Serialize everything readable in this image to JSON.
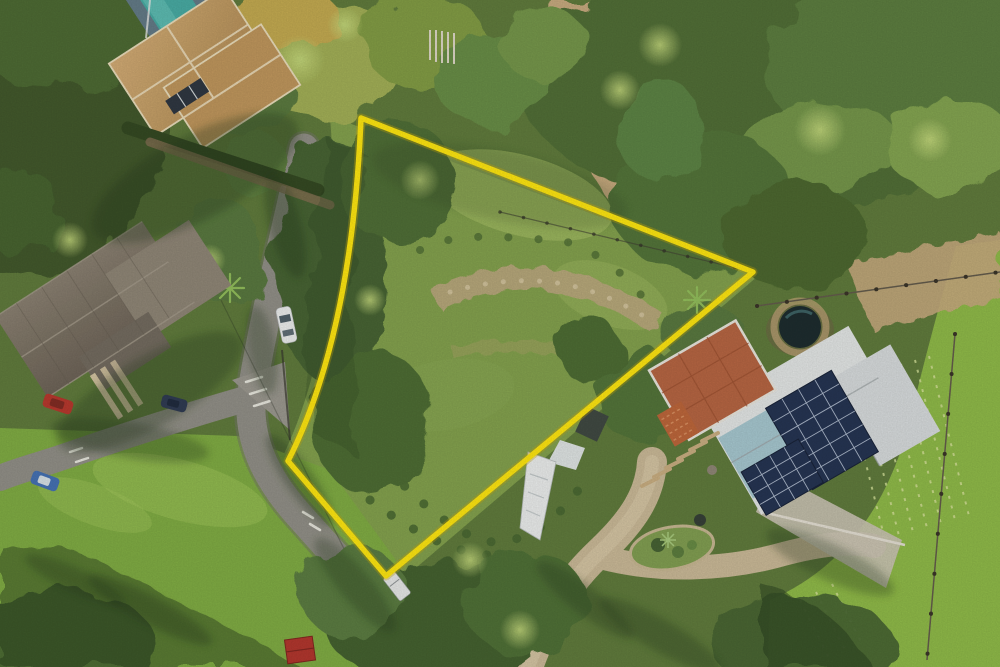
{
  "scene": {
    "type": "aerial-drone-photo",
    "subject": "vacant sloped land parcel outlined in yellow between neighboring homes",
    "base_color": "#5A7838",
    "sun_wash_color": "#FFEDB0"
  },
  "boundary": {
    "name": "property-boundary",
    "color": "#FFE70A",
    "glow_color": "#C8A800",
    "stroke_width": 5.5,
    "path_d": "M 361 118 L 753 272 L 386 576 L 288 461 Q 352 335 361 118 Z",
    "vertices": [
      [
        361,
        118
      ],
      [
        753,
        272
      ],
      [
        386,
        576
      ],
      [
        288,
        461
      ]
    ]
  },
  "lot": {
    "d": "M 330 116 L 758 276 L 390 590 L 280 462 Q 346 330 330 116 Z",
    "grass_color": "#7F9F4A",
    "rock_band_color": "#B7A67B",
    "rock_dot_color": "#CFC19A",
    "scrub_dot_color": "#41612C"
  },
  "fields": {
    "southwest_d": "M 0 428 L 238 436 L 330 470 L 396 560 L 420 667 L 0 667 Z",
    "southwest_color": "#7CAB3F",
    "east_d": "M 956 246 L 1000 240 L 1000 667 L 768 667 L 770 600 Q 872 556 908 428 Q 928 344 956 246 Z",
    "east_color": "#8CB944",
    "row_color": "#D4E29A"
  },
  "dirt_track": {
    "d": "M 552 0 C 550 55 560 105 578 148 C 596 188 616 212 640 226 C 664 238 678 236 668 204 C 652 156 632 78 620 28 C 616 10 612 0 606 0 Z",
    "east_band_d": "M 846 262 L 1000 232 L 1000 298 L 872 330 Z",
    "color": "#C6A97D"
  },
  "roads": {
    "main_d": "M 304 148 C 286 230 262 325 252 392 C 246 438 266 478 298 514 C 334 554 386 614 428 652 C 442 664 452 667 458 667",
    "west_d": "M 256 396 C 198 412 118 438 60 458 C 36 466 14 472 0 478",
    "color": "#8E8D86",
    "edge_color": "#6F6F68",
    "marking_color": "#E9E9E1"
  },
  "driveway": {
    "main_d": "M 528 667 C 546 618 566 584 600 552 C 634 520 650 494 652 462",
    "branch_d": "M 604 558 C 660 572 722 570 776 556 C 812 546 846 540 874 546",
    "color": "#C9B897",
    "center_color": "#D8C9A8"
  },
  "houses": {
    "northwest": {
      "roof_color": "#C8A169",
      "wing_color": "#BE9459",
      "ridge_color": "#EADDBC",
      "pool_color": "#41AAA4",
      "deck_color": "#5E7886",
      "skylight_color": "#27313D",
      "hedge_color": "#2C431D",
      "drive_color": "#7D6A4E"
    },
    "west": {
      "roof_color": "#7B7265",
      "wing_color": "#8C8375",
      "ext_color": "#6E675C",
      "plank_color": "#D2C2A0"
    },
    "east": {
      "roof_white": "#E3E7E9",
      "roof_white2": "#D7DCDF",
      "roof_blue": "#9CC3CF",
      "brick_color": "#B4613E",
      "brick_line_color": "#97492B",
      "solar_color": "#1D2D4F",
      "solar_grid_color": "#B9C6DA",
      "plunge_pool_color": "#142529",
      "terrace_color": "#C9C3B4",
      "brick_pile_color": "#BC6236"
    }
  },
  "vehicles": {
    "white_car_color": "#ECEFF0",
    "red_car_color": "#B53228",
    "blue_car_color": "#3E6DB4",
    "dark_car_color": "#27354F",
    "white_trailer_color": "#E6E9EA"
  },
  "vegetation": {
    "tree_dark": "#3A5226",
    "tree_mid": "#4B6B33",
    "tree_light": "#6F9446",
    "crown_highlight": "#C6DC7C",
    "palm_color": "#8FBE58"
  },
  "misc": {
    "shed_roof_color": "#B03028",
    "tarp_color": "#ECEFF0",
    "fence_color": "#5D5648",
    "picket_color": "#DDD8C8",
    "shadow_color": "#1C3117",
    "log_steps_color": "#C8AD80",
    "garden_bed_color": "#7D9C4E"
  }
}
